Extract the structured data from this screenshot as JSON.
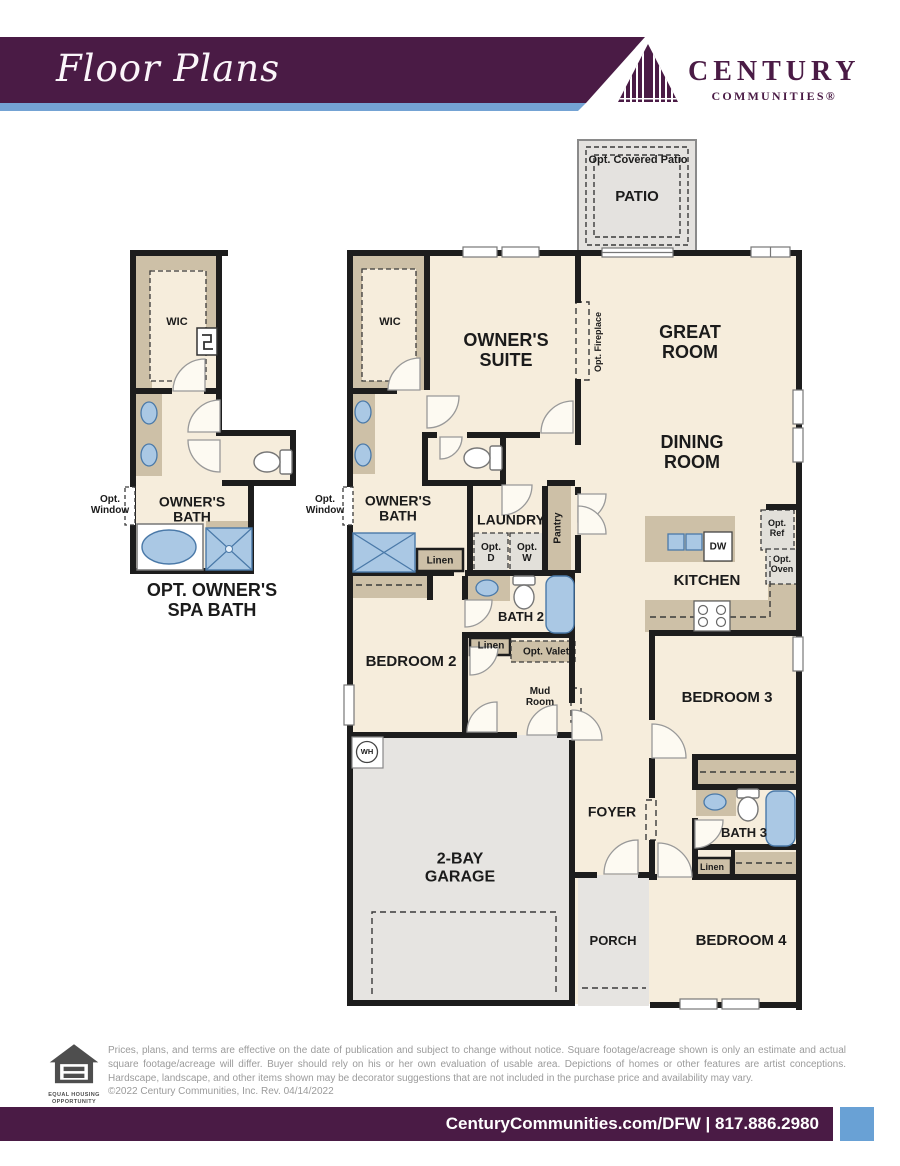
{
  "header": {
    "title": "Floor Plans",
    "logo": {
      "name": "CENTURY",
      "sub": "COMMUNITIES®"
    }
  },
  "plan": {
    "labels": {
      "opt_covered_patio": "Opt. Covered Patio",
      "patio": "PATIO",
      "great_room": "GREAT\nROOM",
      "dining_room": "DINING\nROOM",
      "owners_suite": "OWNER'S\nSUITE",
      "wic": "WIC",
      "owners_bath": "OWNER'S\nBATH",
      "opt_window": "Opt.\nWindow",
      "opt_fireplace": "Opt. Fireplace",
      "laundry": "LAUNDRY",
      "opt_d": "Opt.\nD",
      "opt_w": "Opt.\nW",
      "pantry": "Pantry",
      "kitchen": "KITCHEN",
      "dw": "DW",
      "opt_ref": "Opt.\nRef",
      "opt_oven": "Opt.\nOven",
      "bath2": "BATH 2",
      "linen": "Linen",
      "opt_valet": "Opt. Valet",
      "mud_room": "Mud\nRoom",
      "bedroom2": "BEDROOM 2",
      "wh": "WH",
      "garage": "2-BAY\nGARAGE",
      "foyer": "FOYER",
      "bedroom3": "BEDROOM 3",
      "bath3": "BATH 3",
      "bedroom4": "BEDROOM 4",
      "porch": "PORCH",
      "spa_title": "OPT. OWNER'S\nSPA BATH"
    }
  },
  "footer": {
    "eho_line1": "EQUAL HOUSING",
    "eho_line2": "OPPORTUNITY",
    "disclaimer": "Prices, plans, and terms are effective on the date of publication and subject to change without notice. Square footage/acreage shown is only an estimate and actual square footage/acreage will differ. Buyer should rely on his or her own evaluation of usable area. Depictions of homes or other features are artist conceptions. Hardscape, landscape, and other items shown may be decorator suggestions that are not included in the purchase price and availability may vary.",
    "copyright": "©2022 Century Communities, Inc. Rev. 04/14/2022",
    "bar_text": "CenturyCommunities.com/DFW | 817.886.2980"
  },
  "colors": {
    "purple": "#4a1b45",
    "blue_accent": "#74a3d4",
    "room_fill": "#f6eddc",
    "concrete": "#e6e4e1",
    "counter": "#cdc0a7",
    "fixture_blue": "#aac8e4",
    "wall": "#1d1d1d"
  }
}
